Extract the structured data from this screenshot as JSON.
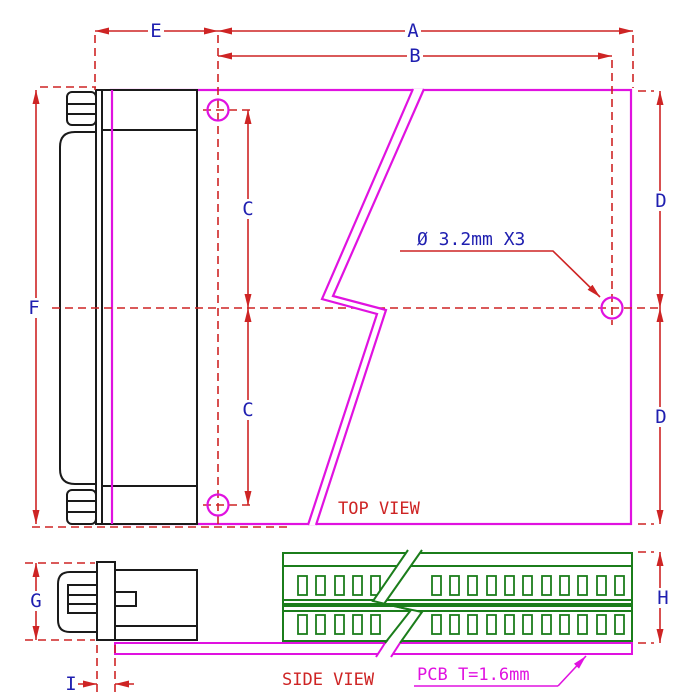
{
  "drawing": {
    "kind": "connector-breakout-board dimension drawing",
    "views": [
      "TOP VIEW",
      "SIDE VIEW"
    ]
  },
  "dims": {
    "a": "A",
    "b": "B",
    "c": "C",
    "d": "D",
    "e": "E",
    "f": "F",
    "g": "G",
    "h": "H",
    "i": "I"
  },
  "top_view": {
    "label": "TOP VIEW",
    "hole_callout": "Ø 3.2mm X3",
    "hole_count": 3,
    "hole_diameter_mm": 3.2
  },
  "side_view": {
    "label": "SIDE VIEW",
    "pcb_note": "PCB T=1.6mm",
    "pcb_thickness_mm": 1.6
  },
  "colors": {
    "outline_magenta": "#E012E0",
    "dimension_red": "#CE2424",
    "label_blue": "#1F1FB0",
    "terminal_green": "#1B7D1B",
    "connector_black": "#1A1A1A"
  }
}
